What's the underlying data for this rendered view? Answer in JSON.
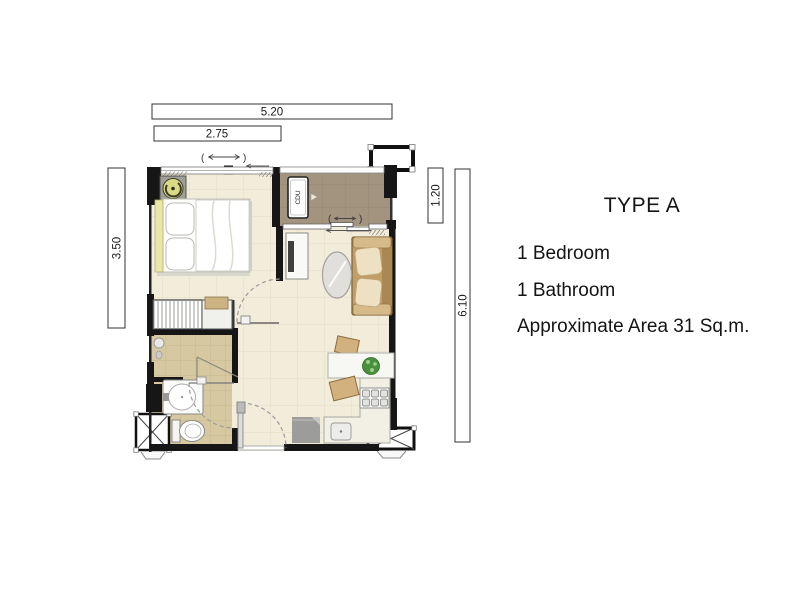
{
  "info_panel": {
    "title": "TYPE A",
    "lines": [
      "1 Bedroom",
      "1 Bathroom",
      "Approximate Area 31 Sq.m."
    ]
  },
  "dimensions": {
    "top_overall": "5.20",
    "top_bedroom": "2.75",
    "left_bedroom": "3.50",
    "right_balcony": "1.20",
    "right_overall": "6.10"
  },
  "plan_labels": {
    "condenser": "CDU"
  },
  "colors": {
    "wall": "#161616",
    "floor_main": "#f2ecdb",
    "floor_balcony": "#a3947f",
    "floor_bath": "#d6c9a2",
    "wood": "#c19e68",
    "headboard": "#e9e6a8",
    "fan": "#d9da84",
    "plant": "#48903a",
    "appliance_gray": "#9c9c9a",
    "background": "#ffffff"
  }
}
